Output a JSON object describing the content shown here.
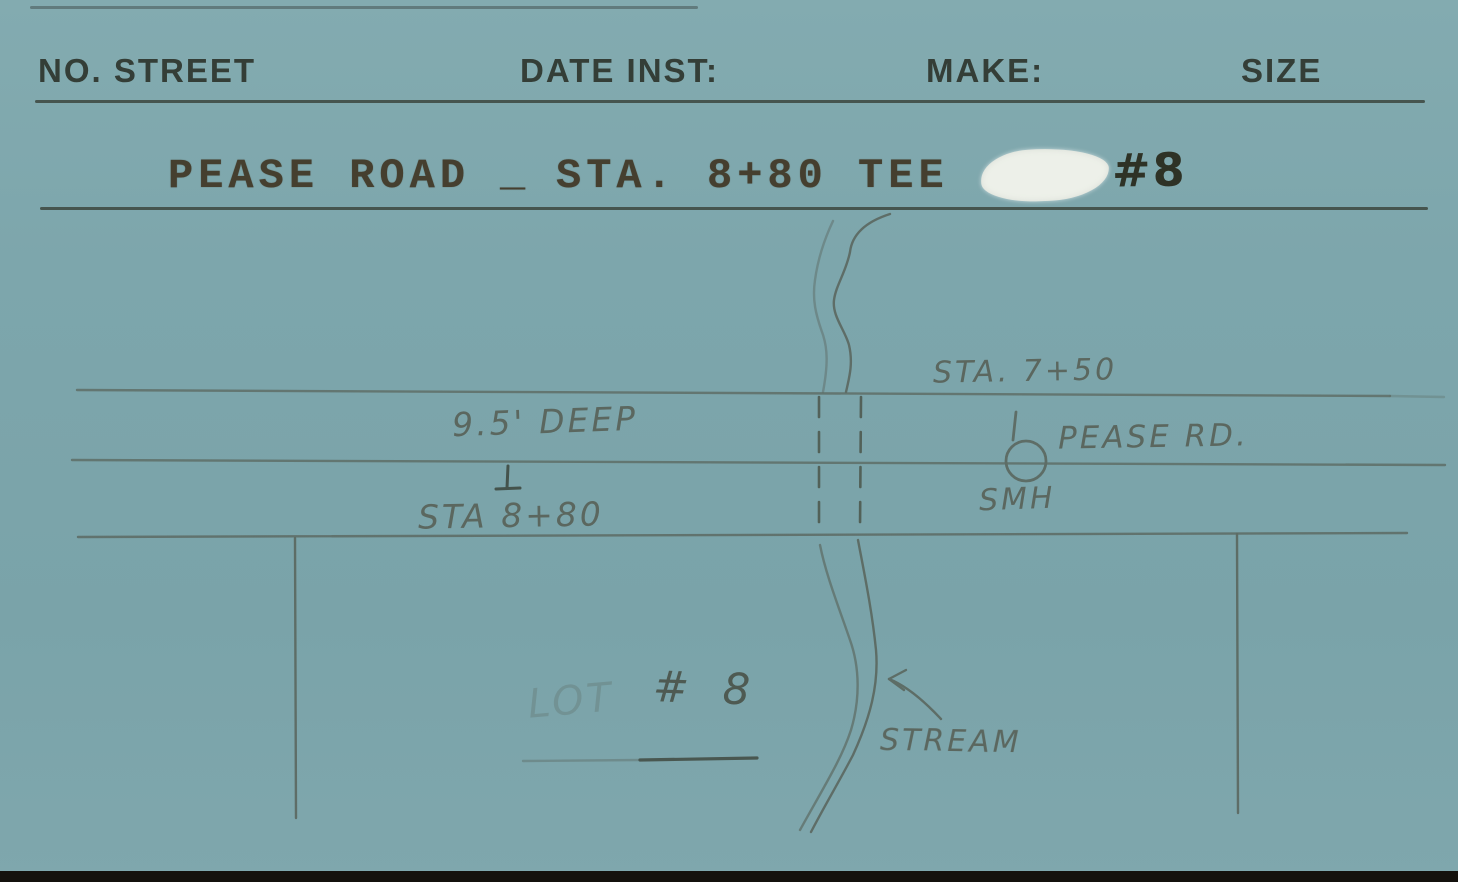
{
  "card": {
    "type": "utility-record-index-card",
    "header": {
      "no_street": "NO. STREET",
      "date_inst": "DATE INST:",
      "make": "MAKE:",
      "size": "SIZE"
    },
    "title_line": {
      "street": "PEASE ROAD",
      "underscore": "_",
      "station": "STA. 8+80 TEE",
      "lot_number": "#8"
    }
  },
  "sketch": {
    "annotations": {
      "sta_750": "STA. 7+50",
      "pease_rd": "PEASE RD.",
      "smh": "SMH",
      "depth": "9.5' DEEP",
      "sta_880": "STA 8+80",
      "lot": "LOT",
      "lot_no": "# 8",
      "stream": "STREAM"
    },
    "features": [
      "three horizontal road edge lines",
      "two vertical lot lines below road",
      "two dashed culvert lines crossing road",
      "double wavy stream line crossing road",
      "manhole circle on center road line at STA 7+50",
      "arrow pointing from STREAM label to stream"
    ]
  },
  "colors": {
    "card_background": "#7da6ac",
    "form_ink": "#343e37",
    "typewriter_ink": "#453f2f",
    "pencil": "#5b675f",
    "whiteout_patch": "#edf0e9",
    "bottom_edge": "#14110d"
  }
}
